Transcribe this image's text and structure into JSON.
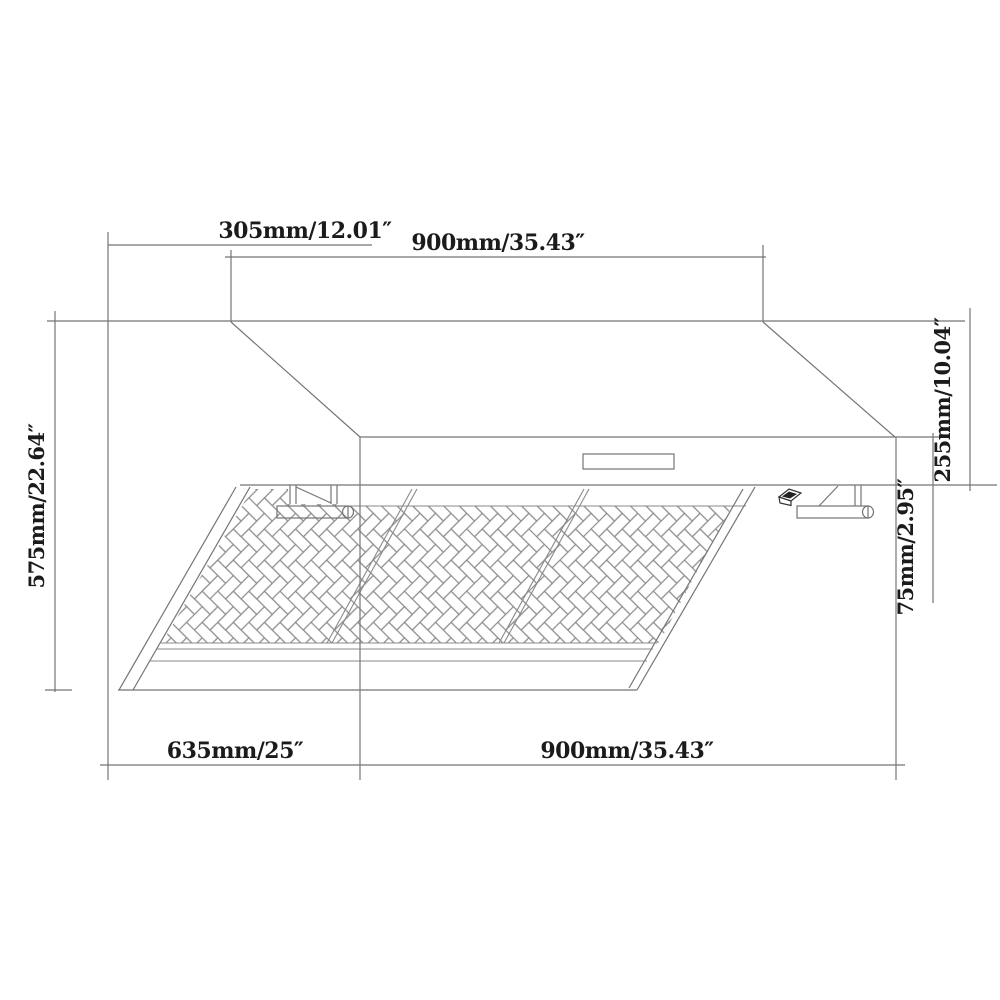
{
  "drawing": {
    "type": "technical-dimension-drawing",
    "subject": "wall-mount range hood, oblique view with baffle filters",
    "background_color": "#ffffff",
    "line_color": "#757575",
    "text_color": "#1b1b1b",
    "dimensions": {
      "top_offset": "305mm/12.01″",
      "top_width": "900mm/35.43″",
      "total_height": "575mm/22.64″",
      "body_height": "255mm/10.04″",
      "front_lip_height": "75mm/2.95″",
      "bottom_depth": "635mm/25″",
      "bottom_width": "900mm/35.43″"
    }
  }
}
